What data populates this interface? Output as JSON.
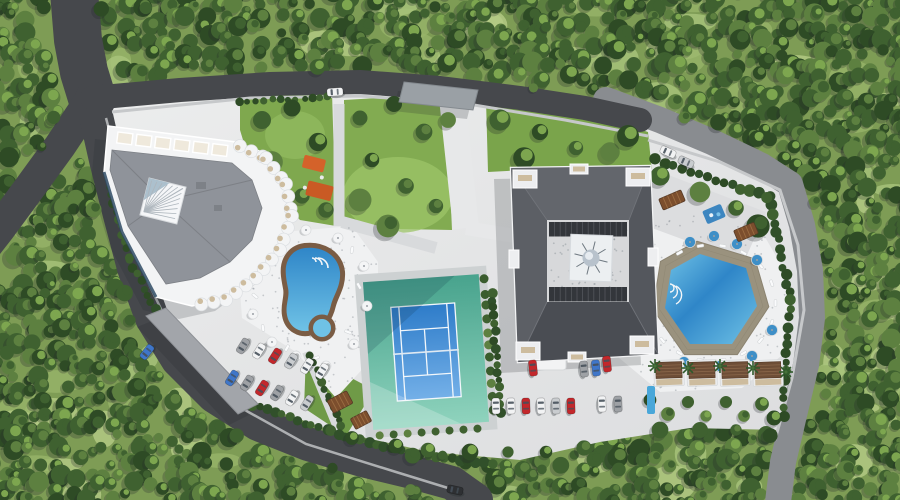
{
  "scene": {
    "type": "aerial-architectural-render",
    "description": "Top-down 3D rendering of a residential resort complex surrounded by dense tree canopy: two apartment buildings, two swimming pools, a tennis court, gardens, playgrounds, pergolas, cabanas and parking lots connected by perimeter roads.",
    "environment": "dense green tree canopy with sunlit lawns"
  },
  "palette": {
    "canopy_dark": "#2e4b25",
    "canopy_mid": "#3f6130",
    "canopy_light": "#5d8040",
    "canopy_highlight": "#7da64f",
    "grass_base": "#7e9c55",
    "grass_light": "#a9c47c",
    "lawn": "#7fa84e",
    "lawn_bright": "#9cc468",
    "road_dark": "#46484c",
    "road_light": "#898c90",
    "sidewalk": "#c6c8ca",
    "pavement": "#e4e5e6",
    "plaza": "#f0f1f2",
    "path": "#d8dadc",
    "roof_left": "#8f939a",
    "building_white": "#f3f4f5",
    "roof_right": "#55585e",
    "courtyard": "#d7d8da",
    "louver": "#33363b",
    "balcony_tan": "#cdbc9e",
    "pool_deep": "#2f86c8",
    "pool_light": "#6fc2e6",
    "pool_pale": "#9fdbef",
    "deck_wood": "#7a5c44",
    "deck_gray": "#9a927e",
    "court_outer": "#48a38d",
    "court_outer_light": "#8fd3bd",
    "court_inner": "#2e7cc9",
    "court_inner_light": "#74b0e8",
    "court_line": "#f2f7fb",
    "umbrella_blue": "#3e8fc7",
    "umbrella_white": "#f4f5f6",
    "pergola_brown": "#7c4e2d",
    "cabana_roof": "#6e4e37",
    "playground_orange": "#d4622a",
    "playground_blue": "#3d86c0",
    "car_white": "#f2f3f4",
    "car_red": "#c3272b",
    "car_blue": "#3f76c9",
    "car_gray": "#9ea1a5",
    "car_silver": "#c9cccf",
    "car_dark": "#2e3033",
    "shadow": "#22262b",
    "window_glass": "#46505a",
    "glass_blue": "#2e4a63"
  },
  "inventory": {
    "buildings": [
      {
        "id": "left-building",
        "style": "angular plan, white scalloped balconies, gray roof, central white atrium skylight with radial glazing"
      },
      {
        "id": "right-building",
        "style": "square plan, dark hip roof around inner courtyard with louvers, central white dome tower"
      }
    ],
    "amenities": [
      {
        "id": "left-pool",
        "shape": "kidney",
        "feature": "kids pool and wood deck rim"
      },
      {
        "id": "right-pool",
        "shape": "hexagonal",
        "feature": "wood deck ring with loungers"
      },
      {
        "id": "tennis-court",
        "surface": "teal apron with blue court and white lines"
      },
      {
        "id": "playground",
        "color": "orange"
      },
      {
        "id": "terrace-playground",
        "color": "blue"
      },
      {
        "id": "pergolas",
        "count": 4
      },
      {
        "id": "cabanas",
        "count": 4
      },
      {
        "id": "entrance-canopy",
        "count": 2
      }
    ],
    "parking": {
      "left_lot_cars": 12,
      "right_lot_cars": 12,
      "street_cars": 5
    },
    "umbrellas": {
      "blue": 8,
      "white": 16
    }
  },
  "cars": [
    {
      "x": 335,
      "y": 92,
      "a": -4,
      "c": "car_white",
      "at": "top-road"
    },
    {
      "x": 668,
      "y": 152,
      "a": 24,
      "c": "car_white",
      "at": "right-road"
    },
    {
      "x": 686,
      "y": 162,
      "a": 24,
      "c": "car_silver",
      "at": "right-road"
    },
    {
      "x": 147,
      "y": 352,
      "a": -52,
      "c": "car_blue",
      "at": "west-road"
    },
    {
      "x": 455,
      "y": 490,
      "a": 12,
      "c": "car_dark",
      "at": "south-road"
    },
    {
      "x": 243,
      "y": 346,
      "a": -58,
      "c": "car_gray",
      "at": "left-lot-row1"
    },
    {
      "x": 259,
      "y": 351,
      "a": -58,
      "c": "car_white",
      "at": "left-lot-row1"
    },
    {
      "x": 275,
      "y": 356,
      "a": -58,
      "c": "car_red",
      "at": "left-lot-row1"
    },
    {
      "x": 291,
      "y": 361,
      "a": -58,
      "c": "car_silver",
      "at": "left-lot-row1"
    },
    {
      "x": 307,
      "y": 366,
      "a": -58,
      "c": "car_white",
      "at": "left-lot-row1"
    },
    {
      "x": 322,
      "y": 371,
      "a": -58,
      "c": "car_white",
      "at": "left-lot-row1"
    },
    {
      "x": 232,
      "y": 378,
      "a": -58,
      "c": "car_blue",
      "at": "left-lot-row2"
    },
    {
      "x": 247,
      "y": 383,
      "a": -58,
      "c": "car_gray",
      "at": "left-lot-row2"
    },
    {
      "x": 262,
      "y": 388,
      "a": -58,
      "c": "car_red",
      "at": "left-lot-row2"
    },
    {
      "x": 277,
      "y": 393,
      "a": -58,
      "c": "car_gray",
      "at": "left-lot-row2"
    },
    {
      "x": 292,
      "y": 398,
      "a": -58,
      "c": "car_white",
      "at": "left-lot-row2"
    },
    {
      "x": 307,
      "y": 403,
      "a": -58,
      "c": "car_silver",
      "at": "left-lot-row2"
    },
    {
      "x": 496,
      "y": 406,
      "a": 88,
      "c": "car_white",
      "at": "right-lot"
    },
    {
      "x": 511,
      "y": 406,
      "a": 88,
      "c": "car_white",
      "at": "right-lot"
    },
    {
      "x": 526,
      "y": 406,
      "a": 88,
      "c": "car_red",
      "at": "right-lot"
    },
    {
      "x": 541,
      "y": 406,
      "a": 88,
      "c": "car_white",
      "at": "right-lot"
    },
    {
      "x": 556,
      "y": 406,
      "a": 88,
      "c": "car_silver",
      "at": "right-lot"
    },
    {
      "x": 571,
      "y": 406,
      "a": 88,
      "c": "car_red",
      "at": "right-lot"
    },
    {
      "x": 602,
      "y": 404,
      "a": 88,
      "c": "car_white",
      "at": "right-lot"
    },
    {
      "x": 618,
      "y": 404,
      "a": 88,
      "c": "car_gray",
      "at": "right-lot"
    },
    {
      "x": 533,
      "y": 368,
      "a": 84,
      "c": "car_red",
      "at": "right-lot-north"
    },
    {
      "x": 584,
      "y": 369,
      "a": 84,
      "c": "car_gray",
      "at": "right-lot-north"
    },
    {
      "x": 596,
      "y": 368,
      "a": 84,
      "c": "car_blue",
      "at": "right-lot-north"
    },
    {
      "x": 607,
      "y": 364,
      "a": 84,
      "c": "car_red",
      "at": "right-lot-north"
    }
  ]
}
